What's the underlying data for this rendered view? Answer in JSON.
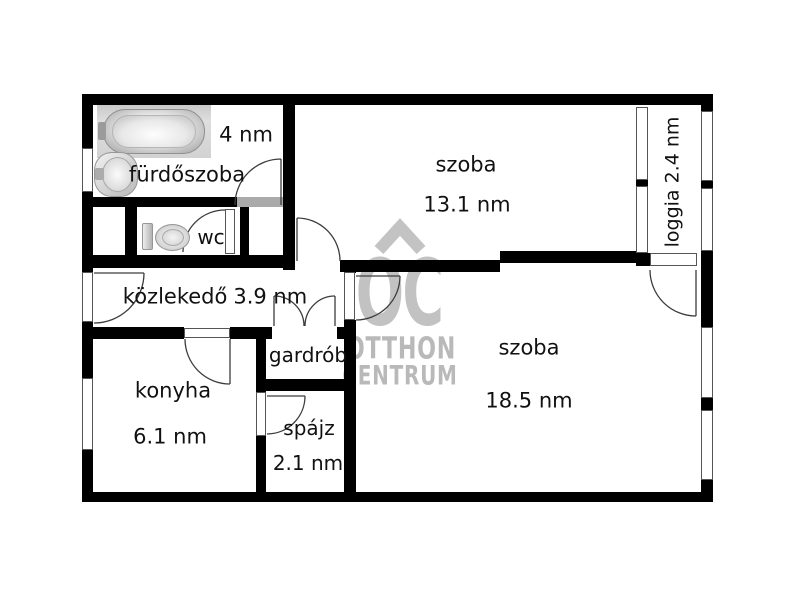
{
  "rooms": {
    "furdoszoba": {
      "name": "fürdőszoba",
      "area": "4 nm"
    },
    "wc": {
      "name": "wc"
    },
    "kozlekedo": {
      "name": "közlekedő",
      "area": "3.9 nm"
    },
    "gardrob": {
      "name": "gardrób"
    },
    "konyha": {
      "name": "konyha",
      "area": "6.1 nm"
    },
    "spajz": {
      "name": "spájz",
      "area": "2.1 nm"
    },
    "szoba_felso": {
      "name": "szoba",
      "area": "13.1 nm"
    },
    "szoba_also": {
      "name": "szoba",
      "area": "18.5 nm"
    },
    "loggia": {
      "name": "loggia",
      "area": "2.4 nm"
    }
  },
  "watermark": {
    "monogram": "OC",
    "line1": "OTTHON",
    "line2": "CENTRUM"
  },
  "colors": {
    "wall": "#000000",
    "threshold": "#aaaaaa",
    "watermark": "#c2c2c2"
  },
  "icons": {
    "bathtub": "bathtub-icon",
    "sink": "sink-icon",
    "toilet": "toilet-icon"
  }
}
